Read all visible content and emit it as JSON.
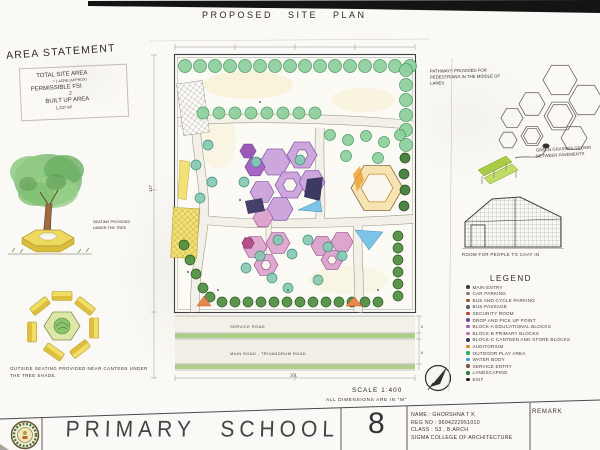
{
  "sheet": {
    "title": "PROPOSED SITE PLAN",
    "scale_note": "SCALE 1:400",
    "dimension_note": "ALL DIMENSIONS ARE IN \"M\""
  },
  "area_statement": {
    "heading": "AREA STATEMENT",
    "line1": "TOTAL SITE AREA",
    "line2": "= 1 ACRE (APPROX)",
    "line3": "PERMISSIBLE FSI",
    "line4": "2",
    "line5": "BUILT UP AREA",
    "line6": "1,337 M²"
  },
  "annotations": {
    "tree_seating": "SEATING PROVIDED UNDER THE TREE",
    "canteen_seating": "OUTSIDE SEATING PROVIDED NEAR CANTEEN UNDER THE TREE SHADE.",
    "pathways": "PATHWAYS PROVIDED FOR PEDESTRIANS IN THE MIDDLE OF LANES",
    "grasses": "GREEN GRASSES GROWN BETWEEN PAVEMENTS",
    "gazebo": "ROOM FOR PEOPLE TO CHAT IN"
  },
  "plan": {
    "service_road": "SERVICE ROAD",
    "main_road": "MAIN ROAD - TRIVANDRUM ROAD",
    "dim_width": "101",
    "dim_height": "147",
    "dim_road": "6"
  },
  "legend": {
    "heading": "LEGEND",
    "items": [
      {
        "label": "MAIN ENTRY",
        "color": "#3d3d3d"
      },
      {
        "label": "CAR PARKING",
        "color": "#7f7f7f"
      },
      {
        "label": "BUS AND CYCLE PARKING",
        "color": "#a0522d"
      },
      {
        "label": "BUS PASSAGE",
        "color": "#55606b"
      },
      {
        "label": "SECURITY ROOM",
        "color": "#c0392b"
      },
      {
        "label": "DROP AND PICK UP POINT",
        "color": "#6d4c91"
      },
      {
        "label": "BLOCK-A EDUCATIONAL BLOCKS",
        "color": "#9b59b6"
      },
      {
        "label": "BLOCK-B PRIMARY BLOCKS",
        "color": "#d06aa8"
      },
      {
        "label": "BLOCK-C CANTEEN AND STORE BLOCKS",
        "color": "#3c3a63"
      },
      {
        "label": "AUDITORIUM",
        "color": "#e67e22"
      },
      {
        "label": "OUTDOOR PLAY AREA",
        "color": "#27ae60"
      },
      {
        "label": "WATER BODY",
        "color": "#3498db"
      },
      {
        "label": "SERVICE ENTRY",
        "color": "#795548"
      },
      {
        "label": "LANDSCAPING",
        "color": "#2e7d32"
      },
      {
        "label": "EXIT",
        "color": "#222222"
      }
    ]
  },
  "title_block": {
    "project": "PRIMARY SCHOOL",
    "sheet_number": "8",
    "name": "NAME : GHORSHNA T K",
    "reg_no": "REG NO : 9694222951010",
    "class_line": "CLASS : S3 , B.ARCH",
    "college": "SIGMA COLLEGE OF ARCHITECTURE",
    "remark": "REMARK"
  }
}
